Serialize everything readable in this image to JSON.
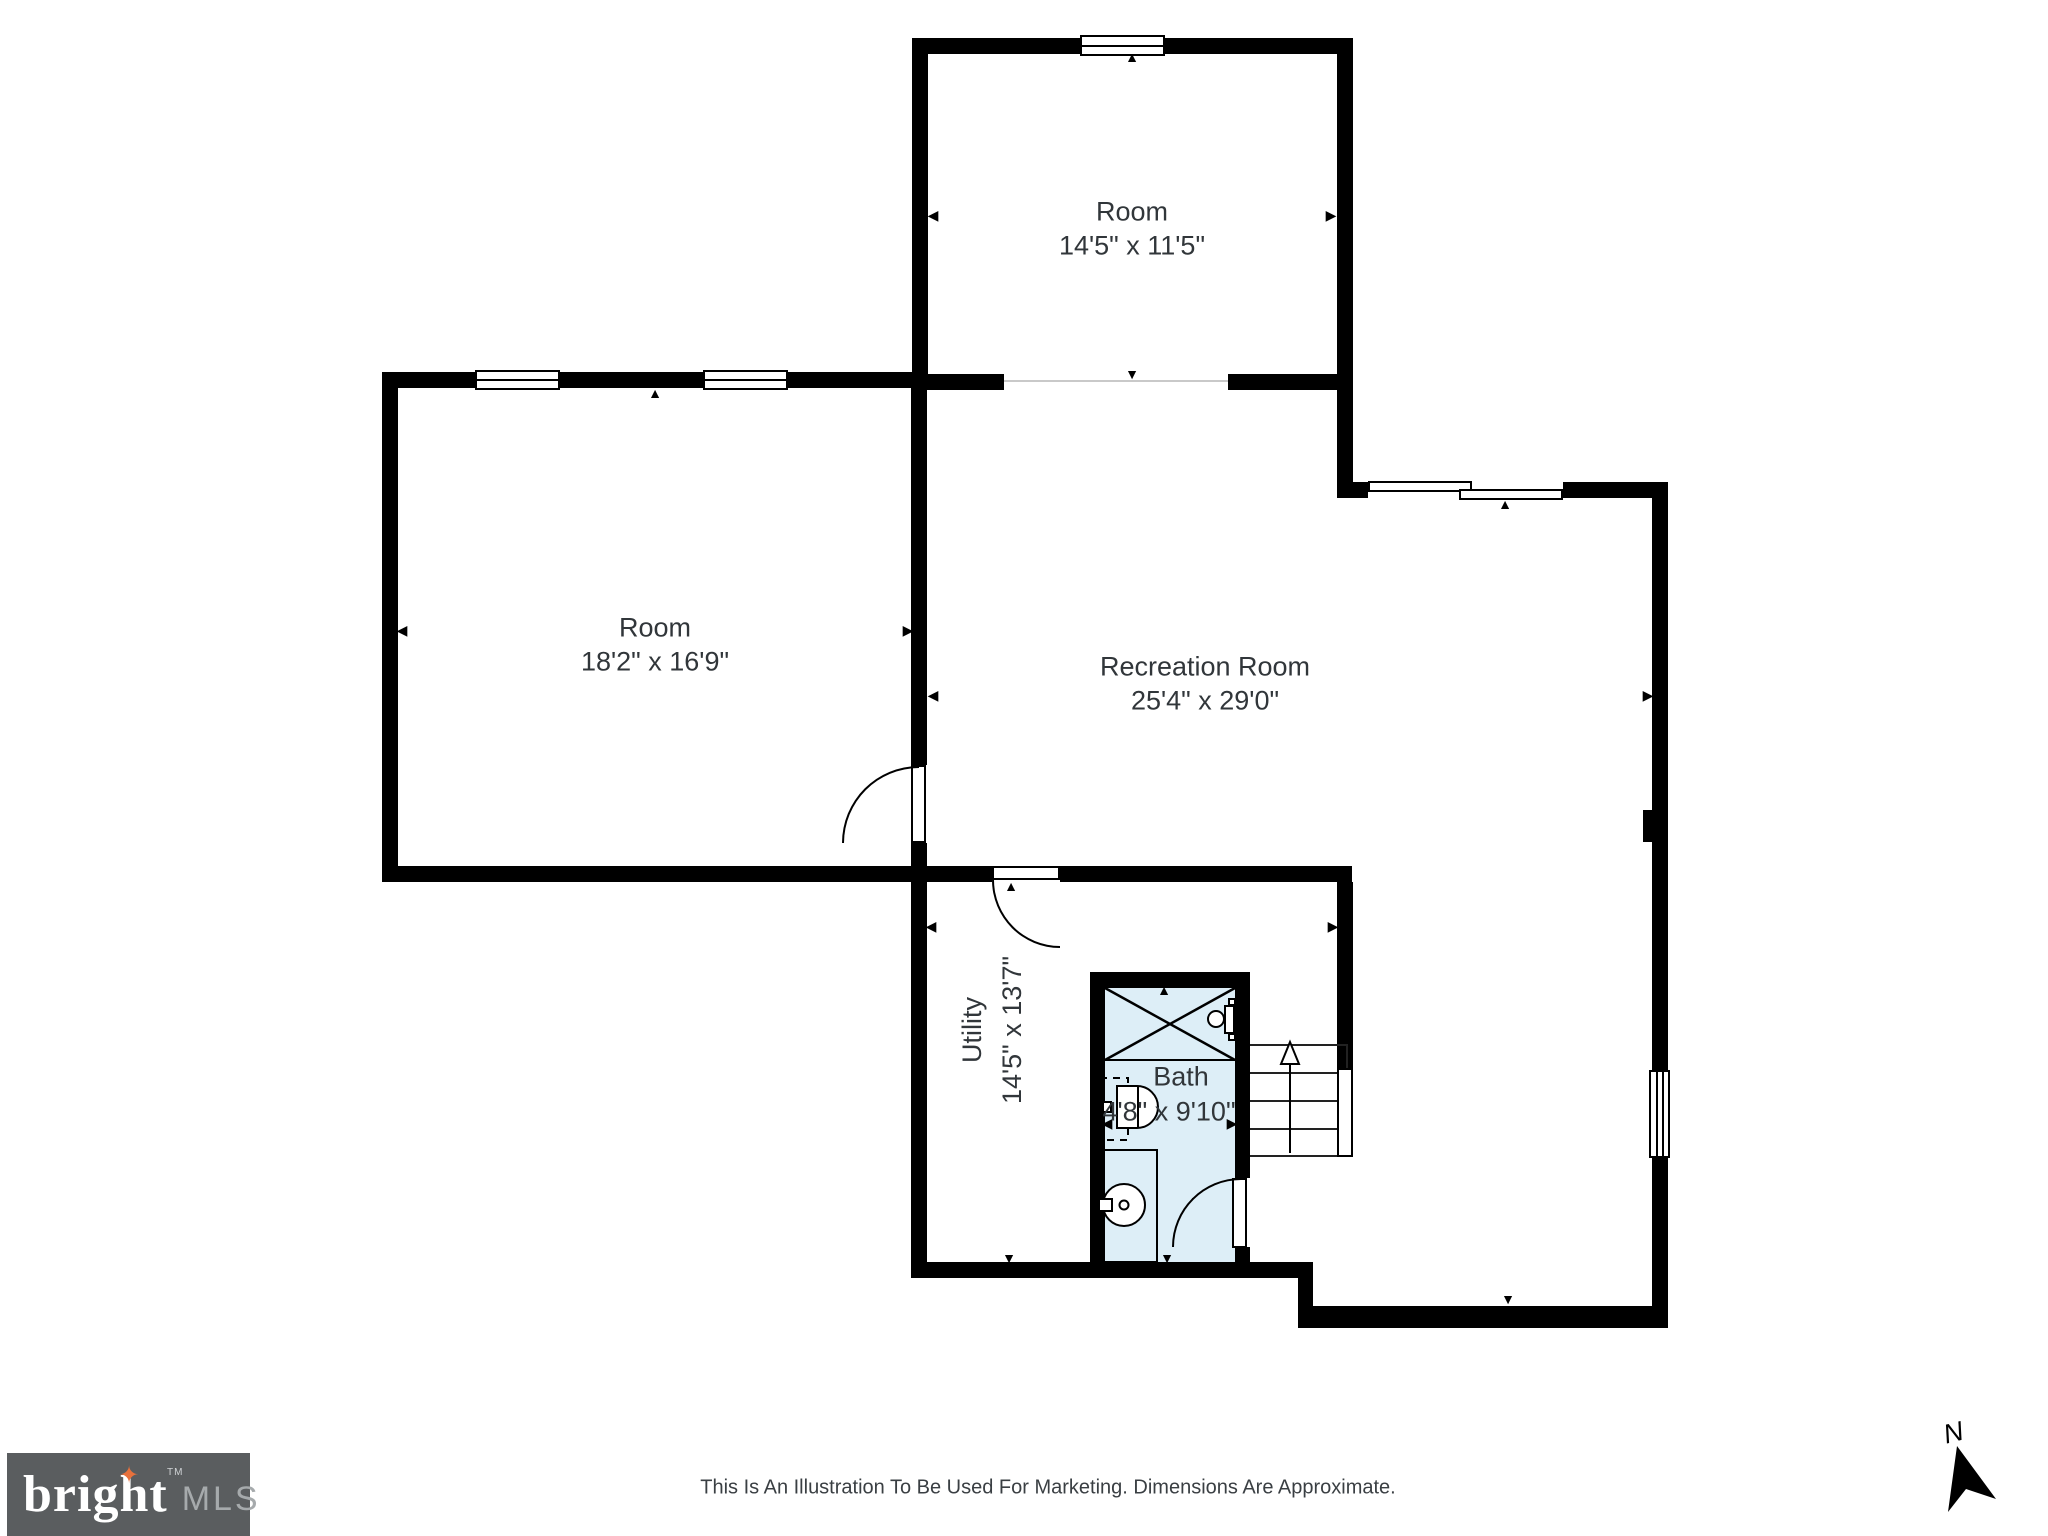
{
  "rooms": {
    "top_room": {
      "name": "Room",
      "dims": "14'5\" x 11'5\""
    },
    "left_room": {
      "name": "Room",
      "dims": "18'2\" x 16'9\""
    },
    "recreation": {
      "name": "Recreation Room",
      "dims": "25'4\" x 29'0\""
    },
    "utility": {
      "name": "Utility",
      "dims": "14'5\" x 13'7\""
    },
    "bath": {
      "name": "Bath",
      "dims": "4'8\" x 9'10\""
    }
  },
  "footer": {
    "disclaimer": "This Is An Illustration To Be Used For Marketing. Dimensions Are Approximate."
  },
  "branding": {
    "logo_word": "bright",
    "logo_tm": "TM",
    "logo_mls": "MLS"
  },
  "compass": {
    "label": "N"
  },
  "colors": {
    "wall": "#000000",
    "ink": "#31363a",
    "bath_fill": "#ddeef7",
    "open_line": "#c9c9c9",
    "logo_bg": "#5a5d5f",
    "logo_star": "#e8713c",
    "logo_mls": "#a6aaac"
  }
}
